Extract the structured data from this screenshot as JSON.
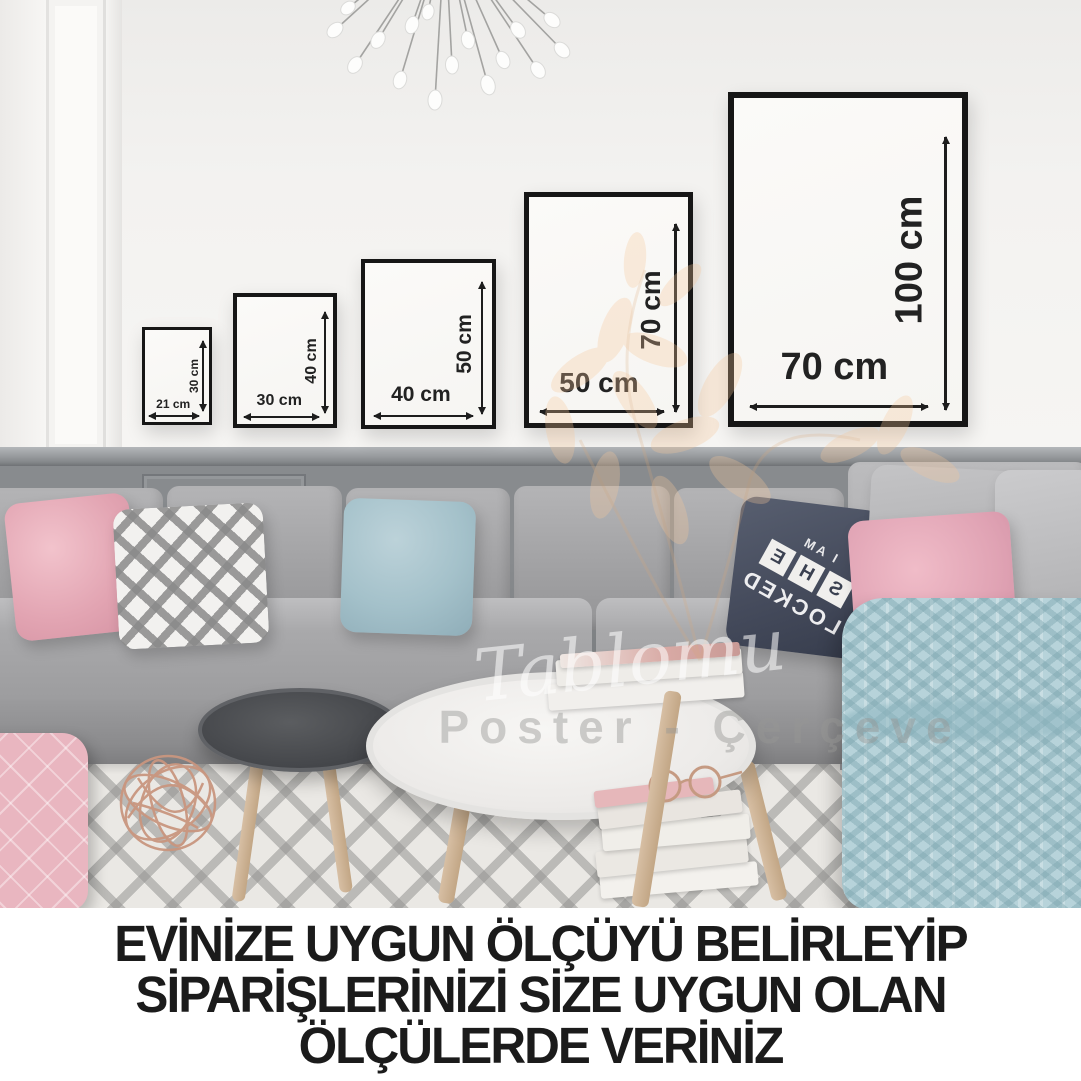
{
  "caption": {
    "line1": "EVİNİZE UYGUN ÖLÇÜYÜ BELİRLEYİP",
    "line2": "SİPARİŞLERİNİZİ SİZE UYGUN OLAN",
    "line3": "ÖLÇÜLERDE VERİNİZ"
  },
  "frames": [
    {
      "id": "21x30",
      "width_label": "21 cm",
      "height_label": "30 cm"
    },
    {
      "id": "30x40",
      "width_label": "30 cm",
      "height_label": "40 cm"
    },
    {
      "id": "40x50",
      "width_label": "40 cm",
      "height_label": "50 cm"
    },
    {
      "id": "50x70",
      "width_label": "50 cm",
      "height_label": "70 cm"
    },
    {
      "id": "70x100",
      "width_label": "70 cm",
      "height_label": "100 cm"
    }
  ],
  "watermark": {
    "script": "Tablomu",
    "subtitle": "Poster - Çerçeve"
  },
  "pillow": {
    "top": "I AM",
    "letters": [
      "S",
      "H",
      "E"
    ],
    "bottom": "LOCKED"
  },
  "colors": {
    "wall": "#f3f2f0",
    "wainscot": "#888b8e",
    "sofa_gray": "#a4a4a6",
    "pillow_pink": "#e2a4b2",
    "pillow_blue": "#a4c1ca",
    "pillow_navy": "#454b5c",
    "blanket_blue": "#b7d3da",
    "rug_base": "#eae8e4",
    "frame_border": "#161616",
    "caption_text": "#1b1b1b",
    "watermark_orange": "#f6c79a"
  }
}
